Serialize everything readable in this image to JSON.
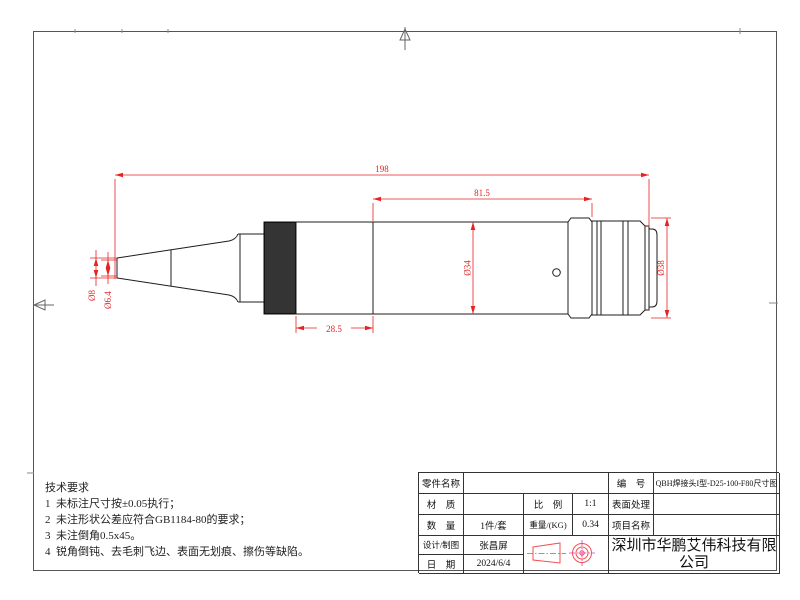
{
  "drawing": {
    "dimensions": {
      "overall_length": "198",
      "front_section_length": "81.5",
      "rear_section_length": "28.5",
      "tip_outer_dia": "Ø8",
      "tip_inner_dia": "Ø6.4",
      "body_dia": "Ø34",
      "connector_dia": "Ø38"
    }
  },
  "tech": {
    "title": "技术要求",
    "items": [
      "1  未标注尺寸按±0.05执行；",
      "2  未注形状公差应符合GB1184-80的要求；",
      "3  未注倒角0.5x45。",
      "4  锐角倒钝、去毛刺飞边、表面无划痕、擦伤等缺陷。"
    ]
  },
  "title_block": {
    "part_name_label": "零件名称",
    "part_name_value": "",
    "number_label": "编　号",
    "number_value": "QBH焊接头I型-D25-100-F80尺寸图",
    "material_label": "材　质",
    "material_value": "",
    "scale_label": "比　例",
    "scale_value": "1:1",
    "surface_label": "表面处理",
    "surface_value": "",
    "quantity_label": "数　量",
    "quantity_value": "1件/套",
    "weight_label": "重量/(KG)",
    "weight_value": "0.34",
    "project_label": "项目名称",
    "project_value": "",
    "designer_label": "设计/制图",
    "designer_value": "张昌屏",
    "date_label": "日　期",
    "date_value": "2024/6/4",
    "company_name": "深圳市华鹏艾伟科技有限公司"
  },
  "colors": {
    "dimension_red": "#e62222",
    "centerline_magenta": "#f030c0",
    "outline_black": "#1c1c1c",
    "border_gray": "#555555"
  }
}
